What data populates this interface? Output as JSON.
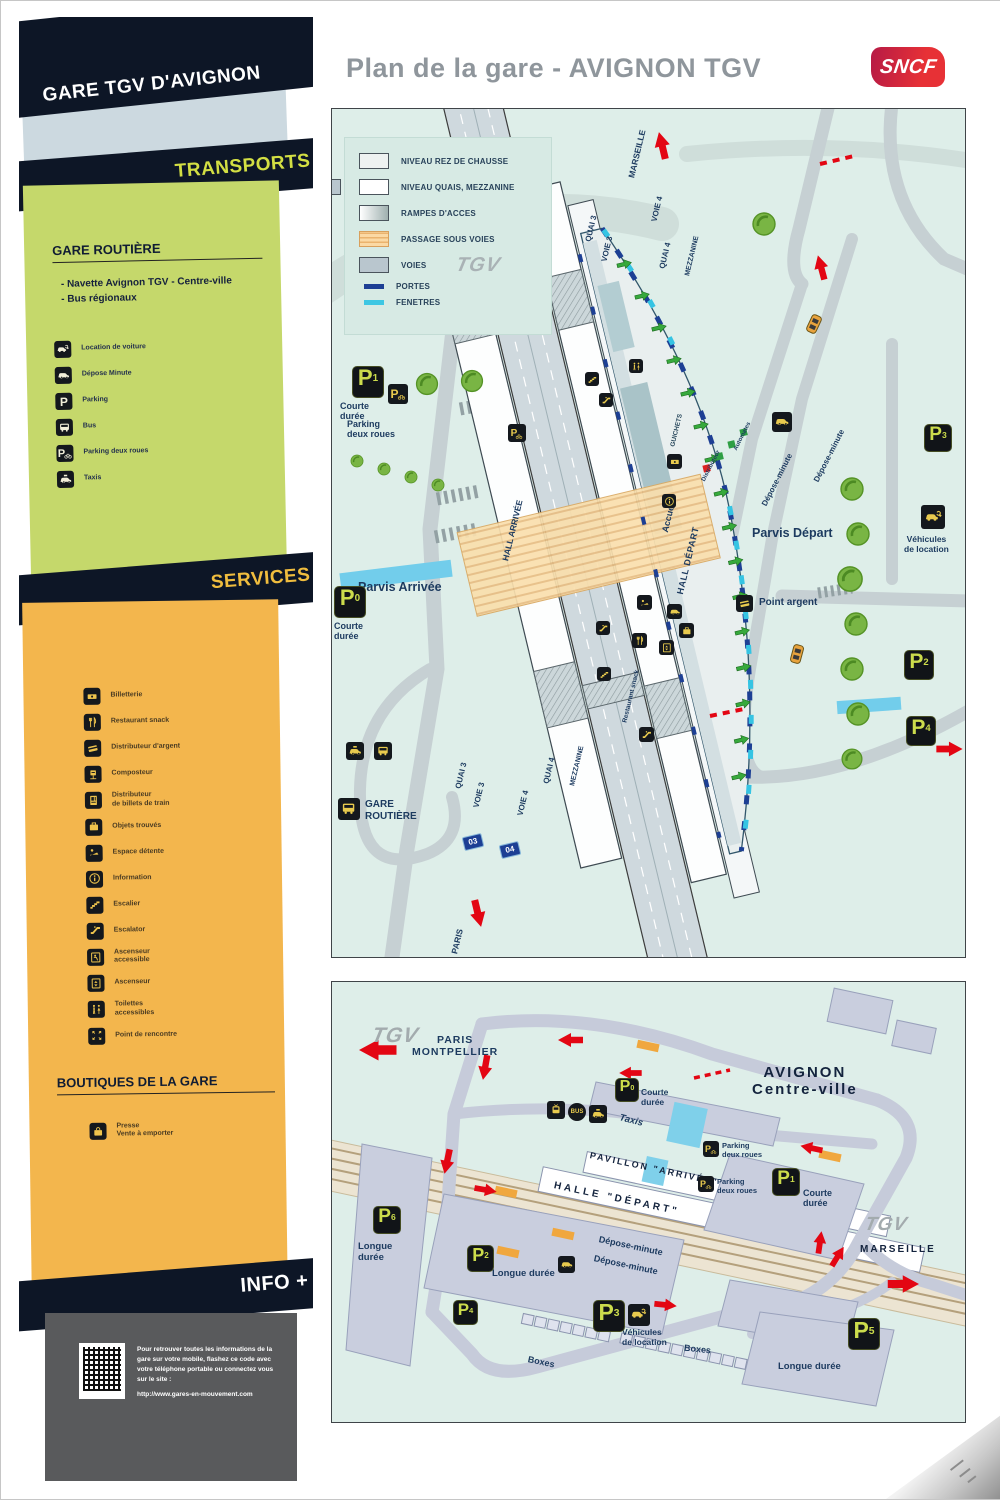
{
  "header": {
    "title": "Plan de la gare - AVIGNON TGV",
    "logo": "SNCF"
  },
  "sidebar": {
    "title": "GARE TGV D'AVIGNON",
    "transports": {
      "banner": "TRANSPORTS",
      "section_title": "GARE ROUTIÈRE",
      "bullets": [
        "- Navette Avignon TGV - Centre-ville",
        "- Bus régionaux"
      ],
      "items": [
        {
          "icon": "car-rental-icon",
          "label": "Location de voiture"
        },
        {
          "icon": "drop-off-icon",
          "label": "Dépose Minute"
        },
        {
          "icon": "parking-icon",
          "label": "Parking"
        },
        {
          "icon": "bus-icon",
          "label": "Bus"
        },
        {
          "icon": "two-wheels-parking-icon",
          "label": "Parking deux roues"
        },
        {
          "icon": "taxi-icon",
          "label": "Taxis"
        }
      ]
    },
    "services": {
      "banner": "SERVICES",
      "items": [
        {
          "icon": "ticket-office-icon",
          "label": "Billetterie"
        },
        {
          "icon": "restaurant-icon",
          "label": "Restaurant snack"
        },
        {
          "icon": "cash-machine-icon",
          "label": "Distributeur d'argent"
        },
        {
          "icon": "ticket-validation-icon",
          "label": "Composteur"
        },
        {
          "icon": "ticket-machine-icon",
          "label": "Distributeur\nde billets de train"
        },
        {
          "icon": "lost-property-icon",
          "label": "Objets trouvés"
        },
        {
          "icon": "rest-area-icon",
          "label": "Espace détente"
        },
        {
          "icon": "information-icon",
          "label": "Information"
        },
        {
          "icon": "stairs-icon",
          "label": "Escalier"
        },
        {
          "icon": "escalator-icon",
          "label": "Escalator"
        },
        {
          "icon": "accessible-lift-icon",
          "label": "Ascenseur\naccessible"
        },
        {
          "icon": "lift-icon",
          "label": "Ascenseur"
        },
        {
          "icon": "accessible-toilets-icon",
          "label": "Toilettes\naccessibles"
        },
        {
          "icon": "meeting-point-icon",
          "label": "Point de rencontre"
        }
      ],
      "boutiques_title": "BOUTIQUES DE LA GARE",
      "boutique_items": [
        {
          "icon": "press-shop-icon",
          "label": "Presse\nVente à emporter"
        }
      ]
    },
    "info": {
      "banner": "INFO +",
      "text": "Pour retrouver toutes les informations de la gare sur votre mobile, flashez ce code avec votre téléphone portable ou connectez vous sur le site :",
      "url": "http://www.gares-en-mouvement.com"
    }
  },
  "legend": {
    "items": [
      {
        "swatch": "ground",
        "label": "NIVEAU REZ DE CHAUSSE"
      },
      {
        "swatch": "platform",
        "label": "NIVEAU QUAIS, MEZZANINE"
      },
      {
        "swatch": "ramp",
        "label": "RAMPES D'ACCES"
      },
      {
        "swatch": "underpass",
        "label": "PASSAGE SOUS VOIES"
      },
      {
        "swatch": "tracks",
        "label": "VOIES"
      },
      {
        "swatch": "doors",
        "label": "PORTES"
      },
      {
        "swatch": "windows",
        "label": "FENETRES"
      }
    ],
    "tgv": "TGV"
  },
  "main_map": {
    "marseille": "MARSEILLE",
    "paris": "PARIS",
    "quai3": "QUAI 3",
    "voie3": "VOIE 3",
    "voie4": "VOIE 4",
    "quai4": "QUAI 4",
    "mezzanine": "MEZZANINE",
    "hall_arrivee": "HALL\nARRIVÉE",
    "hall_depart": "HALL DÉPART",
    "accueil": "Accueil",
    "guichets": "GUICHETS",
    "restauration": "Restaurant snack",
    "automates": "Automates",
    "distributeur": "Distributeur",
    "parvis_arrivee": "Parvis Arrivée",
    "parvis_depart": "Parvis Départ",
    "point_argent": "Point argent",
    "gare_routiere": "GARE\nROUTIÈRE",
    "courte_duree": "Courte\ndurée",
    "parking_deux_roues": "Parking\ndeux roues",
    "depose_minute": "Dépose-minute",
    "vehicules_location": "Véhicules\nde location",
    "sign03": "03",
    "sign04": "04",
    "p": "P",
    "p0_sub": "0",
    "p1_sub": "1",
    "p2_sub": "2",
    "p3_sub": "3",
    "p4_sub": "4"
  },
  "bottom_map": {
    "tgv": "TGV",
    "paris_montpellier": "PARIS\nMONTPELLIER",
    "avignon": "AVIGNON\nCentre-ville",
    "marseille": "MARSEILLE",
    "pavillon": "PAVILLON \"ARRIVÉE\"",
    "halle": "HALLE \"DÉPART\"",
    "taxis": "Taxis",
    "bus_badge": "BUS",
    "courte_duree": "Courte\ndurée",
    "longue_duree": "Longue durée",
    "longue_duree2": "Longue\ndurée",
    "depose_minute": "Dépose-minute",
    "parking_deux_roues": "Parking\ndeux roues",
    "vehicules_location": "Véhicules\nde location",
    "boxes": "Boxes",
    "p": "P",
    "p0_sub": "0",
    "p1_sub": "1",
    "p2_sub": "2",
    "p3_sub": "3",
    "p4_sub": "4",
    "p5_sub": "5",
    "p6_sub": "6"
  }
}
